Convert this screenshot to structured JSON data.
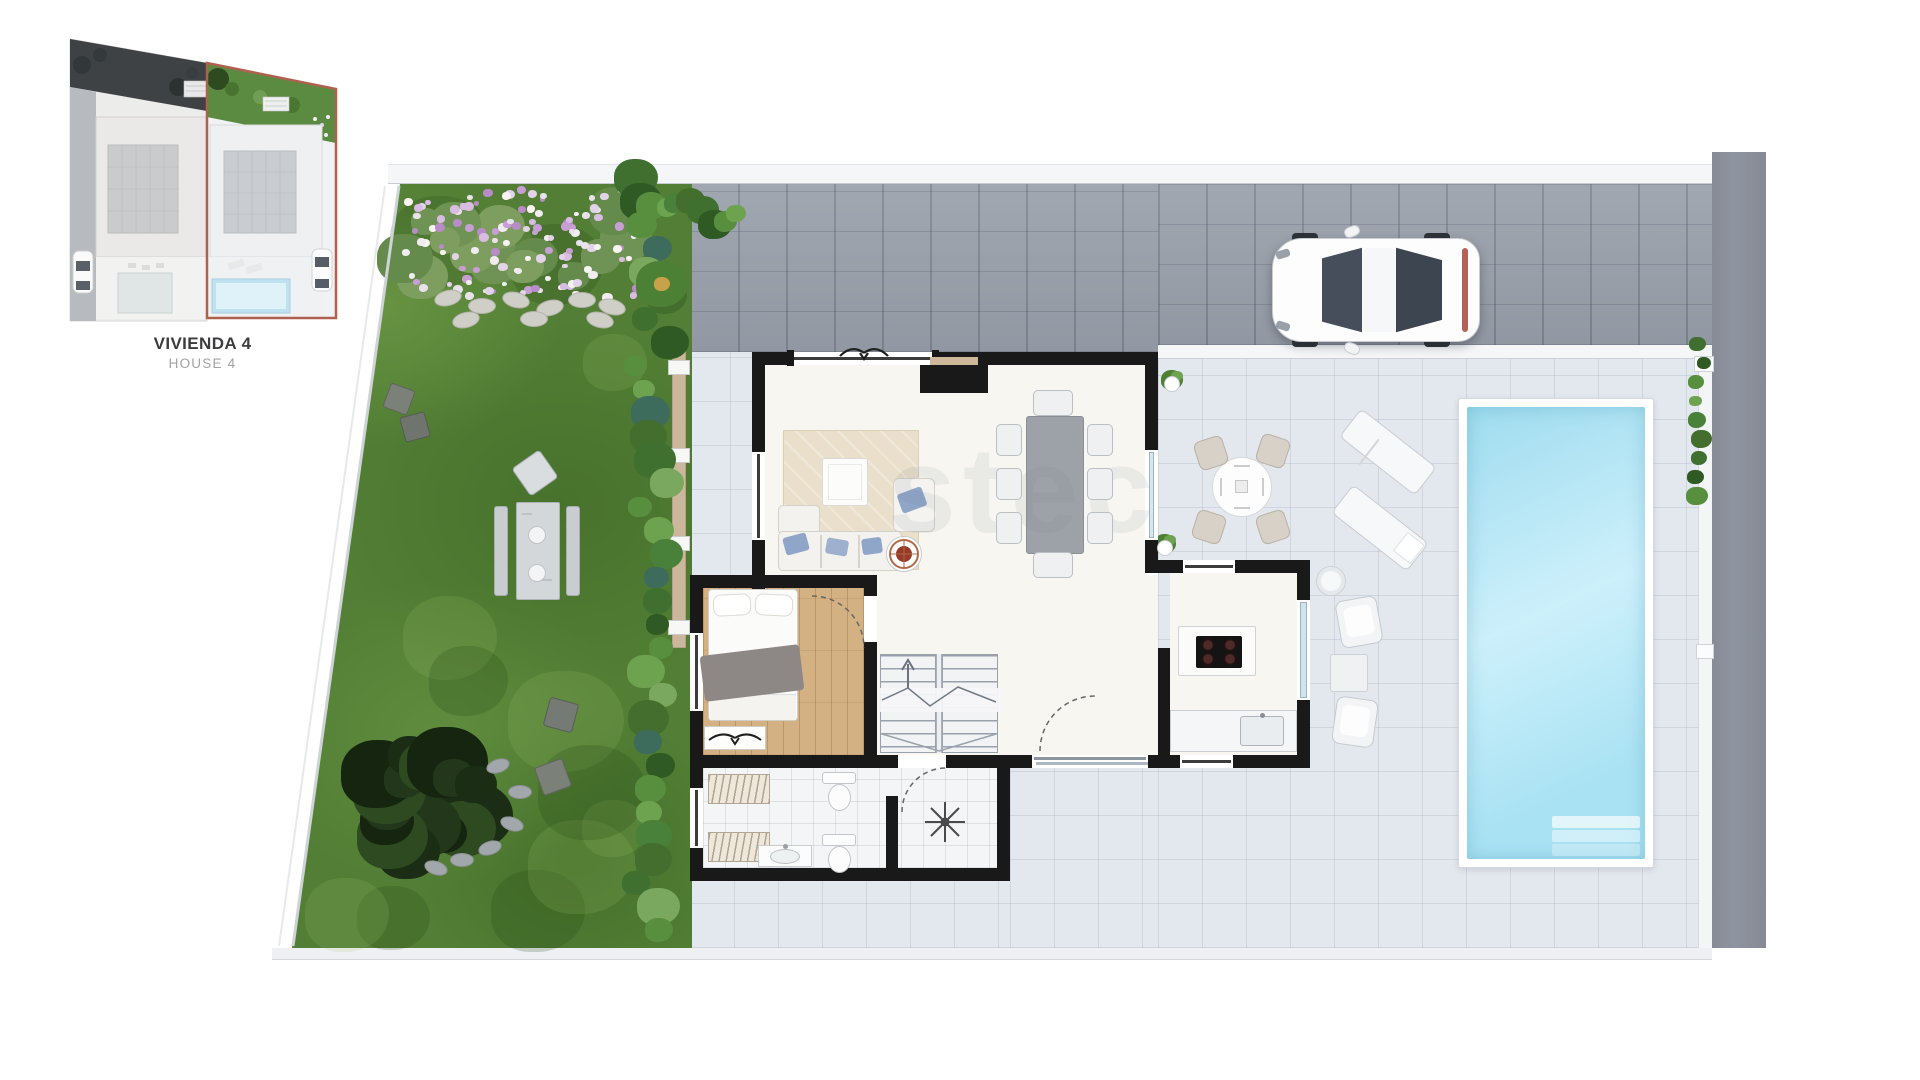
{
  "inset": {
    "caption_primary": "VIVIENDA 4",
    "caption_secondary": "HOUSE 4",
    "highlight_border_color": "#b0604e"
  },
  "watermark": {
    "text": "stec"
  },
  "colors": {
    "wall_black": "#191919",
    "garden_green": "#527e35",
    "pool_water": "#b5e6f4",
    "terrace_gray": "#e3e7ee",
    "driveway_gray": "#99a0ab",
    "street_gray": "#8a8f9a",
    "wood_floor": "#d3b183",
    "highlight_red": "#b0604e"
  }
}
